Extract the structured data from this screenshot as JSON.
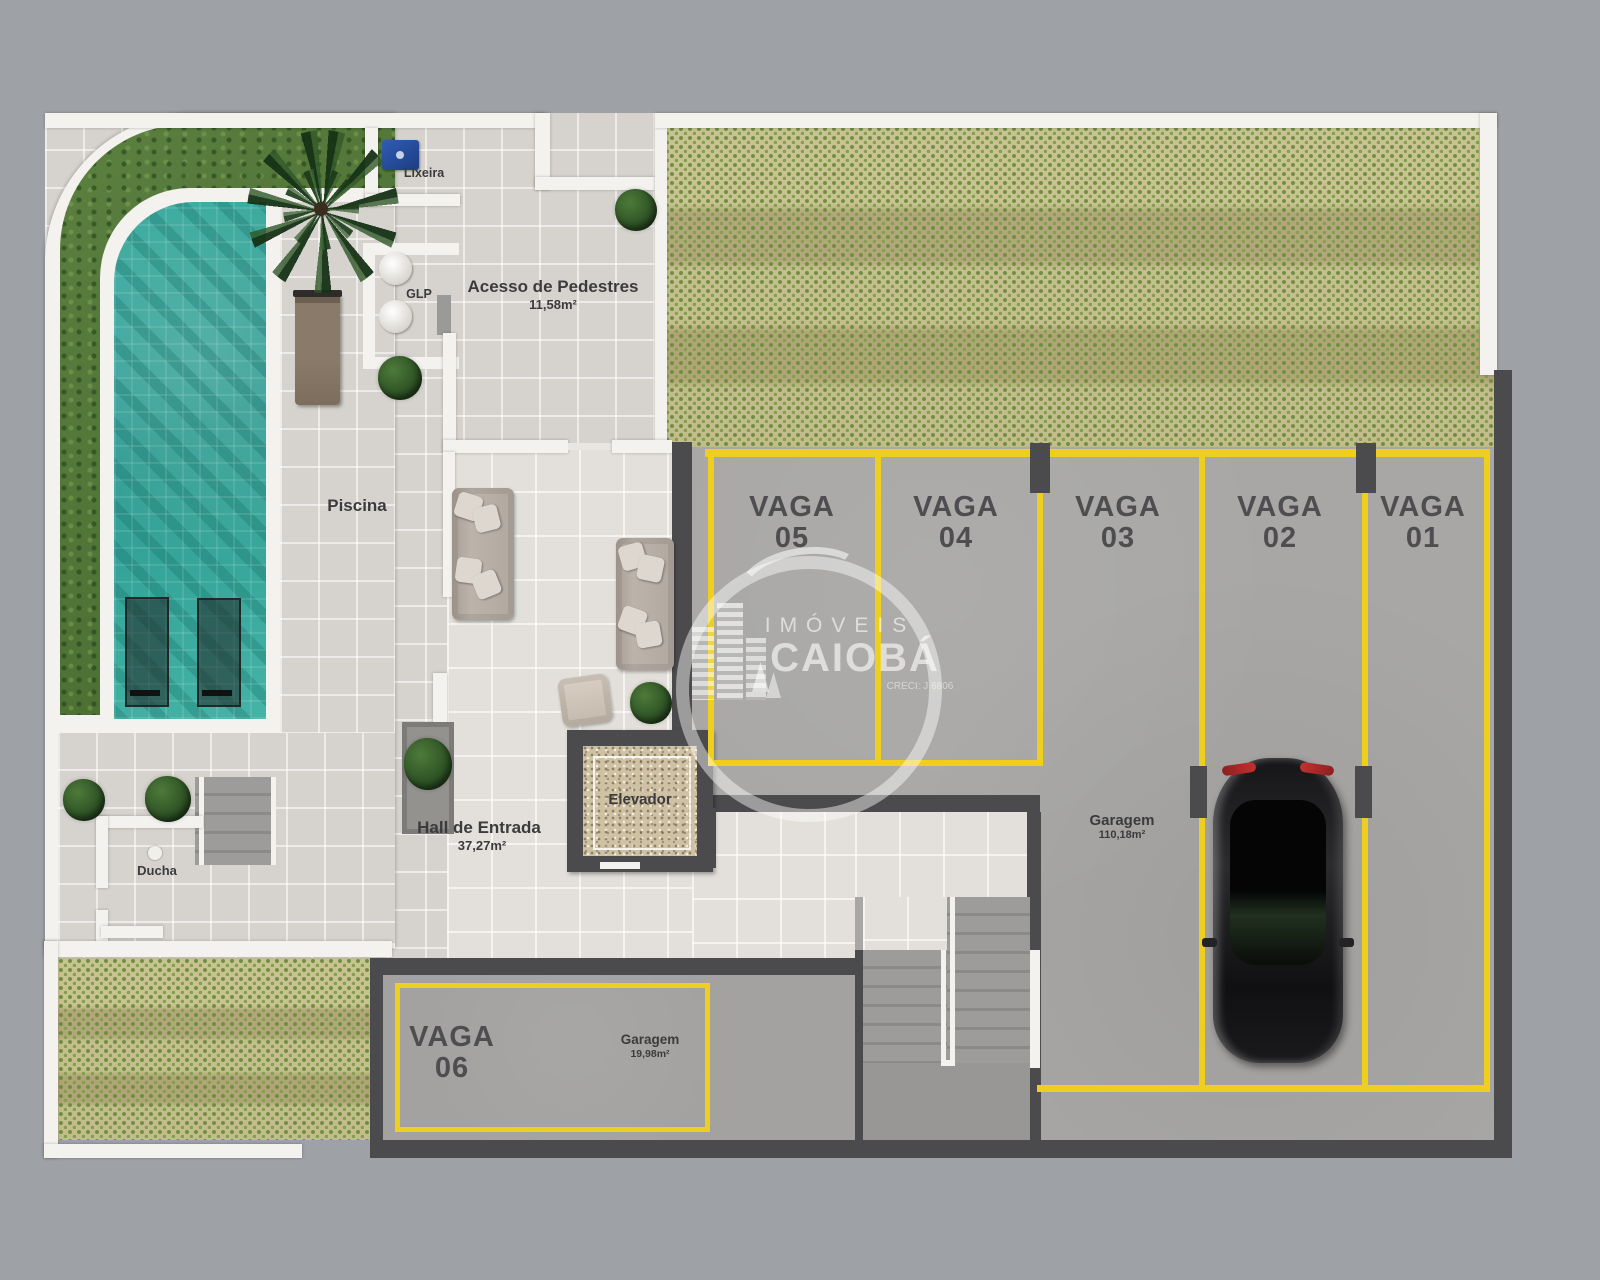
{
  "areas": {
    "piscina": {
      "label": "Piscina"
    },
    "lixeira": {
      "label": "Lixeira"
    },
    "glp": {
      "label": "GLP"
    },
    "acesso": {
      "label": "Acesso de Pedestres",
      "area": "11,58m²"
    },
    "hall": {
      "label": "Hall de Entrada",
      "area": "37,27m²"
    },
    "elevador": {
      "label": "Elevador"
    },
    "ducha": {
      "label": "Ducha"
    },
    "garagem": {
      "label": "Garagem",
      "area": "110,18m²"
    },
    "garagem_vaga06": {
      "label": "Garagem",
      "area": "19,98m²"
    }
  },
  "parking": {
    "spots": [
      {
        "label": "VAGA",
        "number": "05"
      },
      {
        "label": "VAGA",
        "number": "04"
      },
      {
        "label": "VAGA",
        "number": "03"
      },
      {
        "label": "VAGA",
        "number": "02"
      },
      {
        "label": "VAGA",
        "number": "01"
      },
      {
        "label": "VAGA",
        "number": "06"
      }
    ]
  },
  "watermark": {
    "brand_top": "IMÓVEIS",
    "brand_main": "CAIOBÁ",
    "creci": "CRECI: J 6806"
  },
  "colors": {
    "background": "#9ea2a6",
    "wall_white": "#f3f2ef",
    "wall_dark": "#4b4b4d",
    "pool_teal": "#35a89c",
    "grass_green": "#53783c",
    "deck_tile": "#d6d3ce",
    "hall_tile": "#e3e0db",
    "concrete": "#a8a7a5",
    "paver_green": "#bdb887",
    "marking_yellow": "#eecf1d",
    "label_text": "#3b3b3d",
    "dumpster_blue": "#2a55a8"
  }
}
